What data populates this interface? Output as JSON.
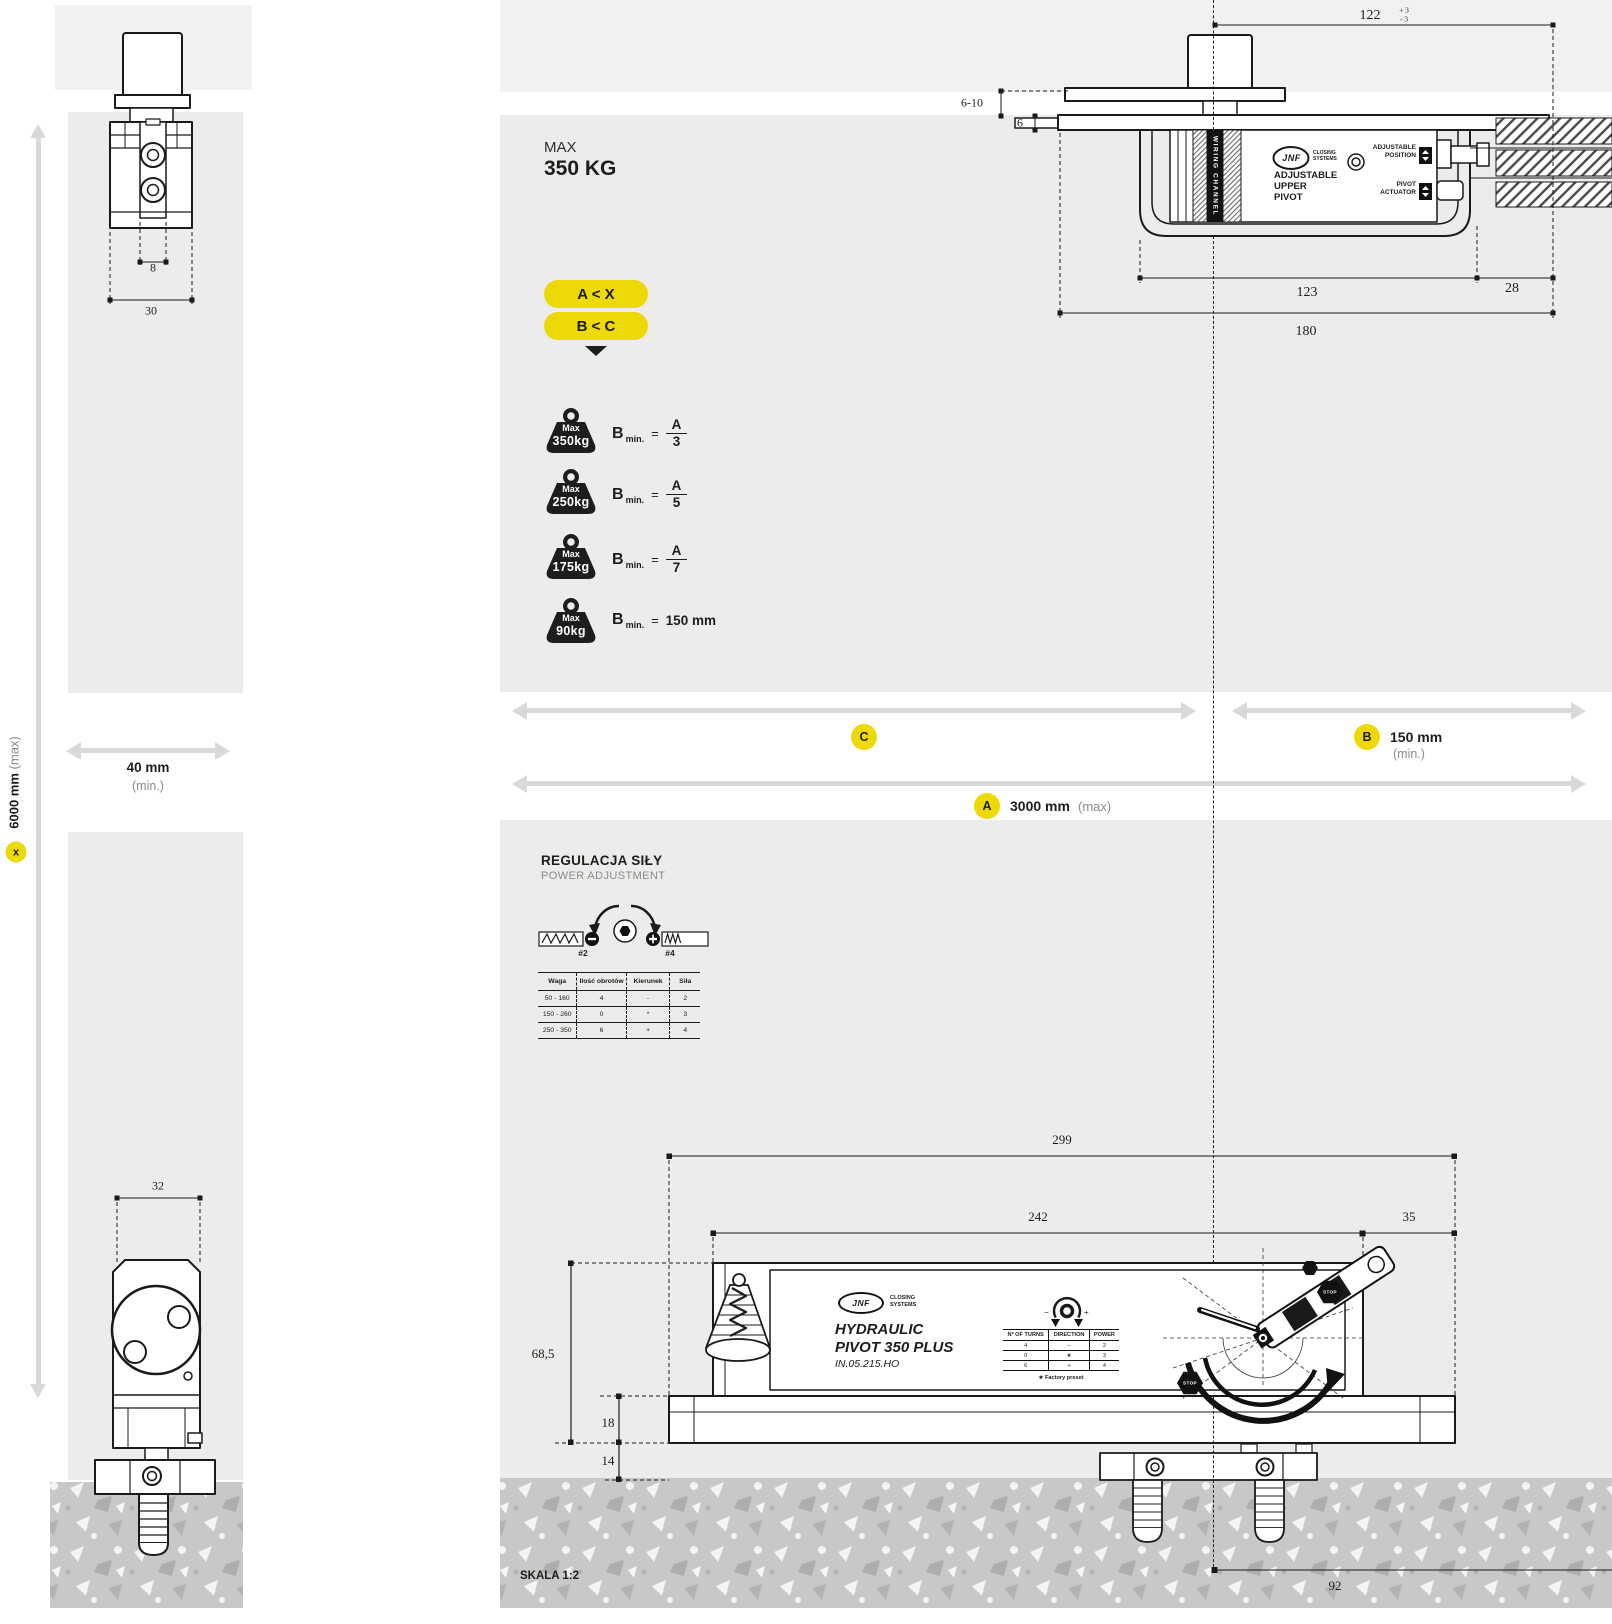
{
  "colors": {
    "accent": "#ecd906",
    "panel": "#ececea",
    "panel_light": "#f1f1ef",
    "floor": "#c8c8c6",
    "arrow": "#d9d9d7",
    "ink": "#1d1d1b"
  },
  "left_view": {
    "top_dims": {
      "d8": "8",
      "d30": "30"
    },
    "bottom_dims": {
      "d32": "32"
    },
    "height": {
      "value": "6000 mm",
      "suffix": "(max)",
      "badge": "x"
    },
    "width": {
      "value": "40 mm",
      "suffix": "(min.)"
    }
  },
  "max_load": {
    "label": "MAX",
    "value": "350 KG"
  },
  "rules": {
    "rule1": "A < X",
    "rule2": "B < C"
  },
  "weights": {
    "prefix": "B",
    "sub": "min.",
    "eq": "=",
    "items": [
      {
        "top": "Max",
        "kg": "350kg",
        "num": "A",
        "den": "3"
      },
      {
        "top": "Max",
        "kg": "250kg",
        "num": "A",
        "den": "5"
      },
      {
        "top": "Max",
        "kg": "175kg",
        "num": "A",
        "den": "7"
      },
      {
        "top": "Max",
        "kg": "90kg",
        "value": "150 mm"
      }
    ]
  },
  "upper_pivot": {
    "dims": {
      "d122": "122",
      "tol_plus": "+ 3",
      "tol_minus": "- 3",
      "d6_10": "6-10",
      "d6": "6",
      "d123": "123",
      "d28": "28",
      "d180": "180"
    },
    "wiring_channel": "WIRING CHANNEL",
    "brand": {
      "name": "JNF",
      "line1": "CLOSING",
      "line2": "SYSTEMS"
    },
    "title": {
      "line1": "ADJUSTABLE",
      "line2": "UPPER",
      "line3": "PIVOT"
    },
    "adjustable_position": {
      "line1": "ADJUSTABLE",
      "line2": "POSITION"
    },
    "pivot_actuator": {
      "line1": "PIVOT",
      "line2": "ACTUATOR"
    }
  },
  "span_dims": {
    "c": {
      "badge": "C"
    },
    "b": {
      "badge": "B",
      "value": "150 mm",
      "suffix": "(min.)"
    },
    "a": {
      "badge": "A",
      "value": "3000 mm",
      "suffix": "(max)"
    }
  },
  "power_adjustment": {
    "title": "REGULACJA SIŁY",
    "subtitle": "POWER ADJUSTMENT",
    "tag_left": "#2",
    "tag_right": "#4",
    "table": {
      "headers": [
        "Waga",
        "Ilość obrotów",
        "Kierunek",
        "Siła"
      ],
      "rows": [
        [
          "50 - 160",
          "4",
          "-",
          "2"
        ],
        [
          "150 - 260",
          "0",
          "*",
          "3"
        ],
        [
          "250 - 350",
          "6",
          "+",
          "4"
        ]
      ]
    }
  },
  "device": {
    "dims": {
      "d299": "299",
      "d242": "242",
      "d35": "35",
      "d68_5": "68,5",
      "d18": "18",
      "d14": "14",
      "d92": "92"
    },
    "brand": {
      "name": "JNF",
      "line1": "CLOSING",
      "line2": "SYSTEMS"
    },
    "product": {
      "line1": "HYDRAULIC",
      "line2": "PIVOT 350 PLUS",
      "code": "IN.05.215.HO"
    },
    "dial": {
      "minus": "−",
      "plus": "+"
    },
    "table": {
      "headers": [
        "Nº OF TURNS",
        "DIRECTION",
        "POWER"
      ],
      "rows": [
        [
          "4",
          "−",
          "2"
        ],
        [
          "0",
          "★",
          "3"
        ],
        [
          "6",
          "+",
          "4"
        ]
      ],
      "footnote": "★ Factory preset"
    },
    "stop_badge": "STOP",
    "scale": "SKALA 1:2"
  }
}
